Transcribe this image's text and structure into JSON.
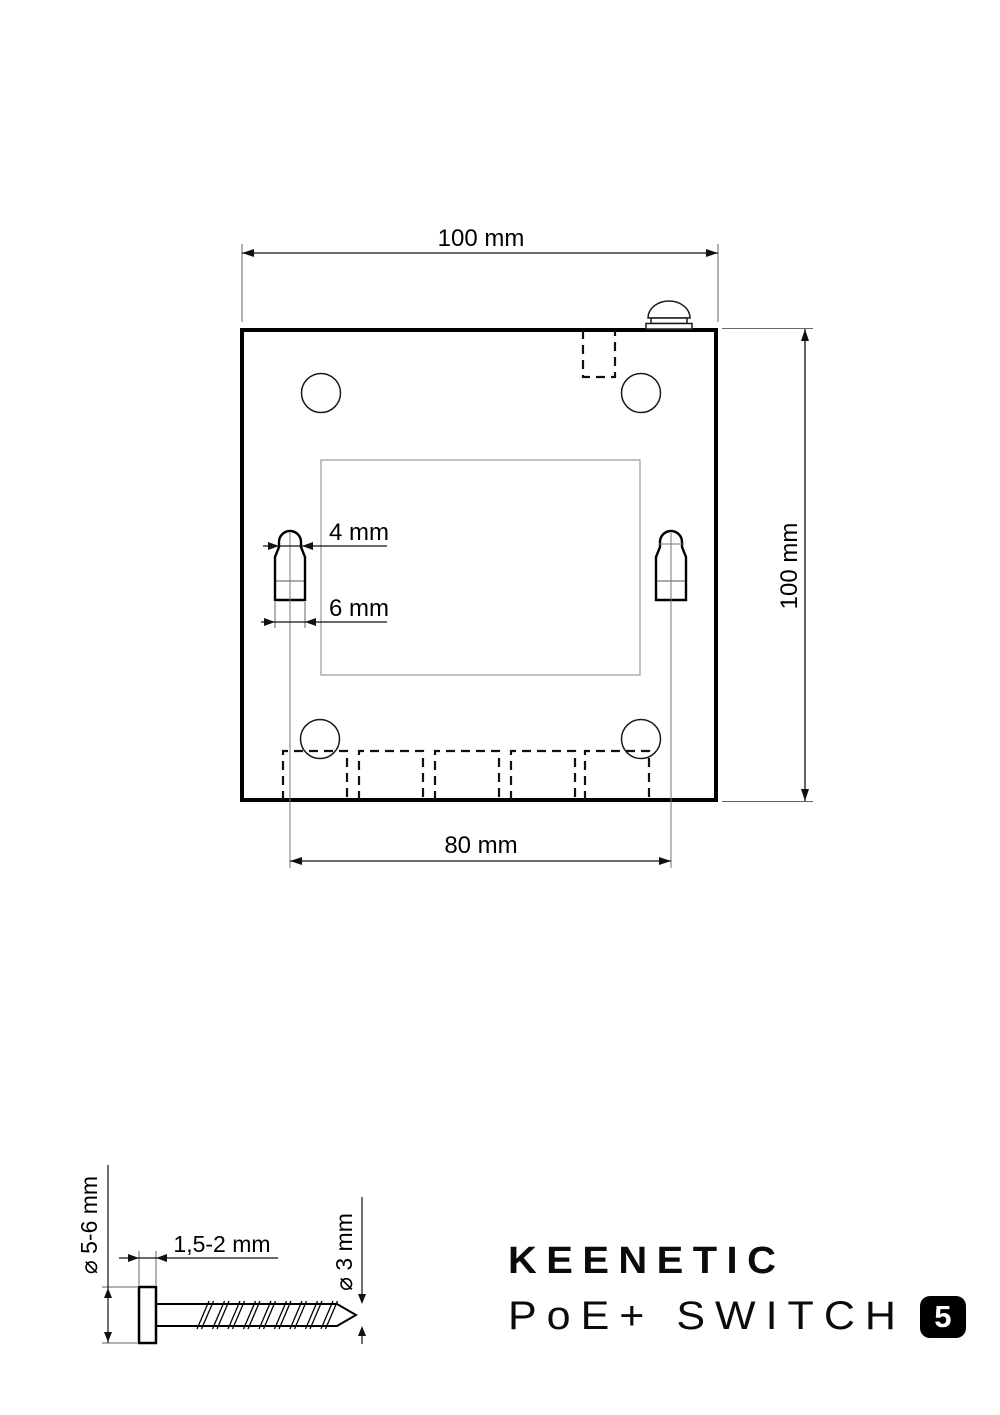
{
  "drawing": {
    "width_dimension": "100 mm",
    "height_dimension": "100 mm",
    "keyhole_spacing_dimension": "80 mm",
    "keyhole_slot_width": "4 mm",
    "keyhole_base_width": "6 mm"
  },
  "screw": {
    "head_diameter": "⌀ 5-6 mm",
    "head_clearance": "1,5-2 mm",
    "shaft_diameter": "⌀ 3 mm"
  },
  "branding": {
    "brand": "KEENETIC",
    "product": "PoE+ SWITCH",
    "port_badge": "5"
  },
  "colors": {
    "line": "#000000",
    "construction_line": "#777777",
    "background": "#ffffff",
    "badge_background": "#000000",
    "badge_text": "#ffffff"
  }
}
